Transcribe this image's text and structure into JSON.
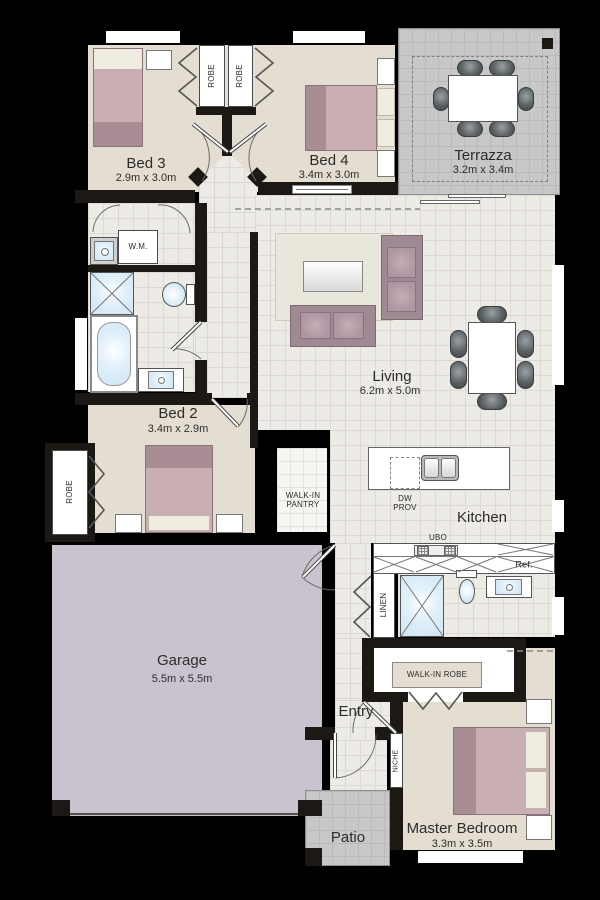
{
  "rooms": {
    "bed3": {
      "name": "Bed 3",
      "dims": "2.9m x 3.0m"
    },
    "bed4": {
      "name": "Bed 4",
      "dims": "3.4m x 3.0m"
    },
    "terrazza": {
      "name": "Terrazza",
      "dims": "3.2m x 3.4m"
    },
    "living": {
      "name": "Living",
      "dims": "6.2m x 5.0m"
    },
    "bed2": {
      "name": "Bed 2",
      "dims": "3.4m x 2.9m"
    },
    "kitchen": {
      "name": "Kitchen"
    },
    "garage": {
      "name": "Garage",
      "dims": "5.5m x 5.5m"
    },
    "entry": {
      "name": "Entry"
    },
    "patio": {
      "name": "Patio"
    },
    "master": {
      "name": "Master Bedroom",
      "dims": "3.3m x 3.5m"
    }
  },
  "labels": {
    "robe": "ROBE",
    "wm": "W.M.",
    "pantry": "WALK-IN PANTRY",
    "dw_prov": "DW PROV",
    "ubo": "UBO",
    "ref": "Ref.",
    "linen": "LINEN",
    "walk_in_robe": "WALK-IN ROBE",
    "niche": "NICHE"
  },
  "colors": {
    "wall": "#1c1915",
    "carpet": "#e3ddd2",
    "tile": "#edebe6",
    "tileLine": "#dcd9d3",
    "terrace": "#c8c8c8",
    "terraceLine": "#bababa",
    "garage": "#c9c3cf",
    "bedDark": "#a98d94",
    "bedMid": "#c9aeb3",
    "pillow": "#f0ecdf",
    "sofa": "#9f8a94",
    "cushion": "#b096a0",
    "chair": "#5c6264",
    "fixture": "#cfe5f4",
    "text": "#2e2c29"
  }
}
